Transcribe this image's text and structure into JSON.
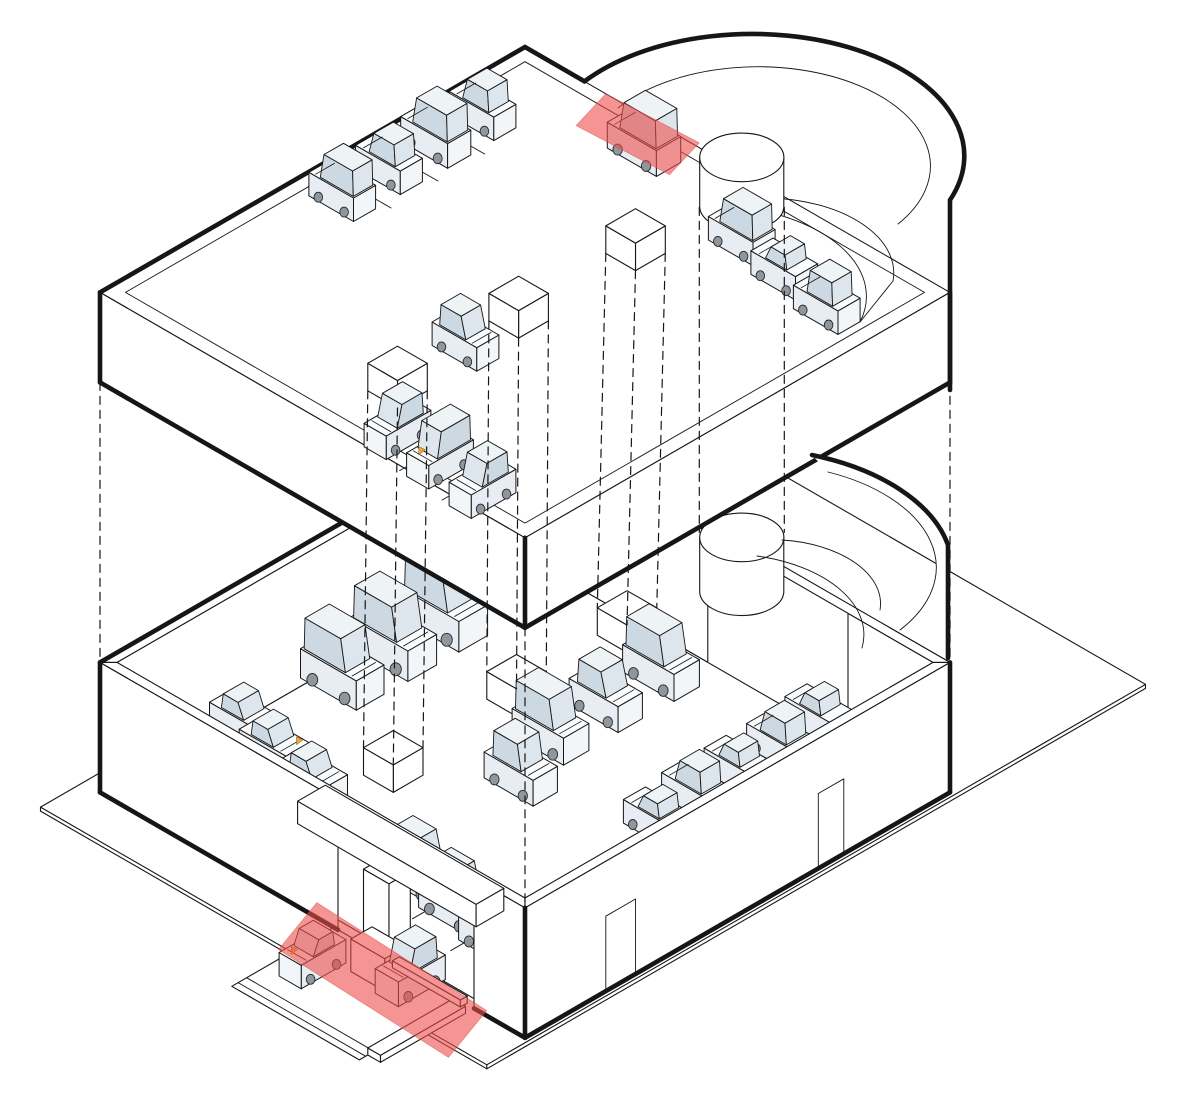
{
  "scene": {
    "iso": {
      "x0": 525,
      "y0": 547,
      "kx": 4.25,
      "ky": 2.454,
      "kz": 5
    },
    "colors": {
      "bg": "#ffffff",
      "line": "#161616",
      "car_body": "#f3f6f9",
      "car_side": "#e7edf2",
      "car_top": "#fbfcfd",
      "cabin_top": "#eef3f6",
      "glass": "#ccd8e2",
      "glass_light": "#dde6ec",
      "wheel": "#8f979e",
      "band": "#ee4f4b",
      "band_edge": "#d84040",
      "flag": "#f2a33c"
    },
    "summary": {
      "levels": [
        {
          "id": "upper-deck",
          "cars": 12,
          "pillar_cubes": 3,
          "scanner_bands": 1
        },
        {
          "id": "street-level",
          "cars": 18,
          "pillar_cubes": 3,
          "scanner_bands": 1
        },
        {
          "id": "outside-driveway",
          "cars": 2,
          "pillar_cubes": 0,
          "scanner_bands": 0
        }
      ],
      "total_cars": 32,
      "ramp": "spiral-ramp-north-east"
    },
    "plate": {
      "corners": [
        [
          -4,
          -45
        ],
        [
          101,
          -45
        ],
        [
          101,
          110
        ],
        [
          -4,
          110
        ]
      ],
      "thickness": 0.8
    },
    "driveway": {
      "a1": 55,
      "a2": 85,
      "b1": 100,
      "b2": 124,
      "curbs": [
        120.5,
        122.5
      ],
      "curb_box": [
        85,
        88,
        102,
        122,
        0,
        1.4
      ]
    },
    "lower": {
      "wall_top": 26,
      "margin": 2,
      "entrance": {
        "a1": 56,
        "a2": 88,
        "h": 20
      },
      "ne_opening": [
        45,
        78
      ],
      "doors": [
        [
          25,
          31,
          15
        ],
        [
          74,
          81,
          15
        ]
      ]
    },
    "upper": {
      "z_floor": 97,
      "z_top": 100,
      "z_bottom": 82,
      "margin": 3,
      "ne_rim_cut": 14
    },
    "canopy": [
      50,
      92,
      97,
      103.5,
      20,
      24.5
    ],
    "post": [
      67,
      73,
      100,
      105,
      0,
      20
    ],
    "machine": [
      66,
      74,
      102,
      107,
      0,
      6.5
    ],
    "arm": [
      74,
      90,
      103.6,
      105.2,
      3.8,
      5.2
    ],
    "ramp": {
      "mask": "M584.5,81.4 A212,122 0 0 1 950,200 L950,292.4 L525,47 Z",
      "outer": "M584.5,81.4 A212,122 0 0 1 950,200 L950,390",
      "inner": "M618,108 A165,95 0 0 1 898,224",
      "helix": [
        "M770,198 A130,75 0 0 1 893,281",
        "M727,206 A158,91 0 0 1 860,322",
        "M860,322 L893,281"
      ],
      "lower_fill": "M812,455 A212,122 0 0 1 948,545 L948,658 L900,630 A180,104 0 0 0 828,472 Z",
      "lower_outer": "M812,455 A212,122 0 0 1 948,545 L948,658",
      "lower_inner": "M828,472 A180,104 0 0 1 900,630",
      "lower_helix": [
        "M782,540 A110,64 0 0 1 880,610",
        "M757,556 A140,81 0 0 1 862,648"
      ],
      "ne_rim_bit": [
        [
          84,
          0
        ],
        [
          100,
          0
        ]
      ]
    },
    "cylinders": [
      {
        "lv": "U",
        "a": 48,
        "b": -3,
        "r": 7,
        "z1": 90,
        "z2": 100
      },
      {
        "lv": "L",
        "a": 48,
        "b": -3,
        "r": 7,
        "z1": 13,
        "z2": 24
      }
    ],
    "cubes": [
      {
        "lv": "U",
        "a": 52,
        "b": 26
      },
      {
        "lv": "U",
        "a": 52,
        "b": 53.5
      },
      {
        "lv": "U",
        "a": 52,
        "b": 82
      },
      {
        "lv": "L",
        "a": 30,
        "b": 6
      },
      {
        "lv": "L",
        "a": 30,
        "b": 32
      },
      {
        "lv": "L",
        "a": 31,
        "b": 62
      }
    ],
    "links": {
      "cube_pairs": [
        [
          [
            52,
            26
          ],
          [
            30,
            6
          ]
        ],
        [
          [
            52,
            53.5
          ],
          [
            30,
            32
          ]
        ],
        [
          [
            52,
            82
          ],
          [
            31,
            62
          ]
        ]
      ],
      "cube_offsets": [
        [
          -3.5,
          3.5
        ],
        [
          3.5,
          -3.5
        ],
        [
          3.5,
          3.5
        ]
      ],
      "corners": [
        [
          0,
          100
        ],
        [
          100,
          100
        ],
        [
          100,
          0
        ]
      ],
      "cyl": [
        [
          43,
          2
        ],
        [
          53,
          -8
        ]
      ]
    },
    "bands": [
      {
        "id": "scanner-band-ramp",
        "pts": [
          [
            18,
            -1,
            99
          ],
          [
            39,
            -2,
            99
          ],
          [
            42,
            8,
            99
          ],
          [
            21,
            9,
            99
          ]
        ]
      },
      {
        "id": "scanner-band-entrance",
        "pts": [
          [
            50,
            99,
            2
          ],
          [
            92,
            101,
            2
          ],
          [
            95,
            113,
            0
          ],
          [
            53,
            111,
            0
          ]
        ]
      }
    ],
    "separators": {
      "upper": [
        [
          [
            2,
            23.5
          ],
          [
            14,
            23.5
          ]
        ],
        [
          [
            2,
            34.5
          ],
          [
            14,
            34.5
          ]
        ],
        [
          [
            2,
            45.5
          ],
          [
            14,
            45.5
          ]
        ],
        [
          [
            68.5,
            88
          ],
          [
            68.5,
            98
          ]
        ],
        [
          [
            79.5,
            89
          ],
          [
            79.5,
            99
          ]
        ]
      ],
      "lower": [
        [
          [
            62.5,
            77
          ],
          [
            62.5,
            89
          ]
        ],
        [
          [
            73.5,
            79
          ],
          [
            73.5,
            91
          ]
        ]
      ]
    },
    "cars": [
      {
        "lv": "U",
        "a": 8,
        "b": 51,
        "ax": "a",
        "d": -1,
        "t": "van"
      },
      {
        "lv": "U",
        "a": 8,
        "b": 40,
        "ax": "a",
        "d": -1,
        "t": "suv"
      },
      {
        "lv": "U",
        "a": 8,
        "b": 29,
        "ax": "a",
        "d": -1,
        "t": "van",
        "s": 1.05
      },
      {
        "lv": "U",
        "a": 8,
        "b": 18,
        "ax": "a",
        "d": -1,
        "t": "suv"
      },
      {
        "lv": "U",
        "a": 63,
        "b": 93,
        "ax": "b",
        "d": 1,
        "t": "suv"
      },
      {
        "lv": "U",
        "a": 74,
        "b": 94,
        "ax": "b",
        "d": 1,
        "t": "van",
        "f": 1
      },
      {
        "lv": "U",
        "a": 85,
        "b": 95,
        "ax": "b",
        "d": 1,
        "t": "suv"
      },
      {
        "lv": "U",
        "a": 53,
        "b": 67,
        "ax": "a",
        "d": 1,
        "t": "suv"
      },
      {
        "lv": "U",
        "a": 64,
        "b": 13,
        "ax": "a",
        "d": -1,
        "t": "van"
      },
      {
        "lv": "U",
        "a": 76,
        "b": 15,
        "ax": "a",
        "d": -1,
        "t": "sedan"
      },
      {
        "lv": "U",
        "a": 88,
        "b": 17,
        "ax": "a",
        "d": -1,
        "t": "jeep"
      },
      {
        "lv": "U",
        "a": 34,
        "b": 6,
        "ax": "a",
        "d": -1,
        "t": "van",
        "s": 1.1
      },
      {
        "lv": "L",
        "a": 8,
        "b": 27,
        "ax": "a",
        "d": 1,
        "t": "van",
        "s": 1.3
      },
      {
        "lv": "L",
        "a": 8,
        "b": 39,
        "ax": "a",
        "d": 1,
        "t": "van",
        "s": 1.3
      },
      {
        "lv": "L",
        "a": 8,
        "b": 51,
        "ax": "a",
        "d": 1,
        "t": "van",
        "s": 1.25
      },
      {
        "lv": "L",
        "a": 6,
        "b": 72,
        "ax": "a",
        "d": 1,
        "t": "sedan",
        "s": 1.05
      },
      {
        "lv": "L",
        "a": 15,
        "b": 74,
        "ax": "a",
        "d": 1,
        "t": "sedan",
        "s": 1.05,
        "f": 1
      },
      {
        "lv": "L",
        "a": 26,
        "b": 76,
        "ax": "a",
        "d": 1,
        "t": "sedan",
        "s": 1.05
      },
      {
        "lv": "L",
        "a": 57,
        "b": 82,
        "ax": "a",
        "d": 1,
        "t": "suv",
        "s": 1.15
      },
      {
        "lv": "L",
        "a": 68,
        "b": 84,
        "ax": "a",
        "d": 1,
        "t": "suv",
        "s": 1.15
      },
      {
        "lv": "L",
        "a": 79,
        "b": 86,
        "ax": "a",
        "d": 1,
        "t": "suv",
        "s": 1.1
      },
      {
        "lv": "L",
        "a": 44,
        "b": 12,
        "ax": "a",
        "d": 1,
        "t": "van",
        "s": 1.15
      },
      {
        "lv": "L",
        "a": 44,
        "b": 25,
        "ax": "a",
        "d": 1,
        "t": "suv",
        "s": 1.1
      },
      {
        "lv": "L",
        "a": 44,
        "b": 38,
        "ax": "a",
        "d": 1,
        "t": "van",
        "s": 1.15
      },
      {
        "lv": "L",
        "a": 49,
        "b": 50,
        "ax": "a",
        "d": 1,
        "t": "jeep",
        "s": 1.1
      },
      {
        "lv": "L",
        "a": 72,
        "b": 3,
        "ax": "a",
        "d": -1,
        "t": "sedan"
      },
      {
        "lv": "L",
        "a": 73,
        "b": 13,
        "ax": "a",
        "d": -1,
        "t": "suv"
      },
      {
        "lv": "L",
        "a": 73,
        "b": 23,
        "ax": "a",
        "d": -1,
        "t": "sedan"
      },
      {
        "lv": "L",
        "a": 73,
        "b": 33,
        "ax": "a",
        "d": -1,
        "t": "suv"
      },
      {
        "lv": "L",
        "a": 74,
        "b": 43,
        "ax": "a",
        "d": -1,
        "t": "sedan"
      },
      {
        "lv": "G",
        "a": 62,
        "b": 112,
        "ax": "b",
        "d": 1,
        "t": "sedan",
        "f": 1
      },
      {
        "lv": "G",
        "a": 77,
        "b": 104,
        "ax": "b",
        "d": 1,
        "t": "suv",
        "s": 1.05
      }
    ]
  }
}
